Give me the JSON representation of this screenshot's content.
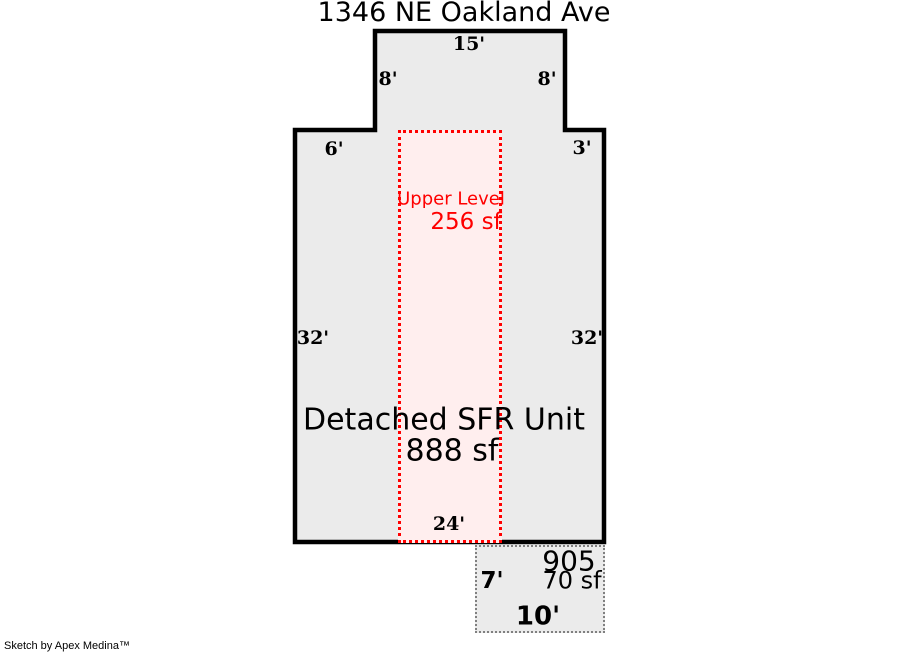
{
  "title": "1346 NE Oakland Ave",
  "main_unit": {
    "label": "Detached SFR Unit",
    "area": "888 sf",
    "dims": {
      "top_width": "15'",
      "upper_left_height": "8'",
      "upper_right_height": "8'",
      "left_offset": "6'",
      "right_offset": "3'",
      "left_height": "32'",
      "right_height": "32'",
      "bottom_width": "24'"
    }
  },
  "upper_level": {
    "label": "Upper Level",
    "area": "256 sf"
  },
  "porch": {
    "number": "905",
    "area": "70 sf",
    "side_height": "7'",
    "bottom_width": "10'"
  },
  "footer": {
    "credit": "Sketch by Apex Medina™"
  },
  "colors": {
    "outline": "#000000",
    "unit-fill": "#ebebeb",
    "upper-fill": "#ffeeee",
    "accent-red": "#ff0000",
    "porch-border": "#808080"
  }
}
